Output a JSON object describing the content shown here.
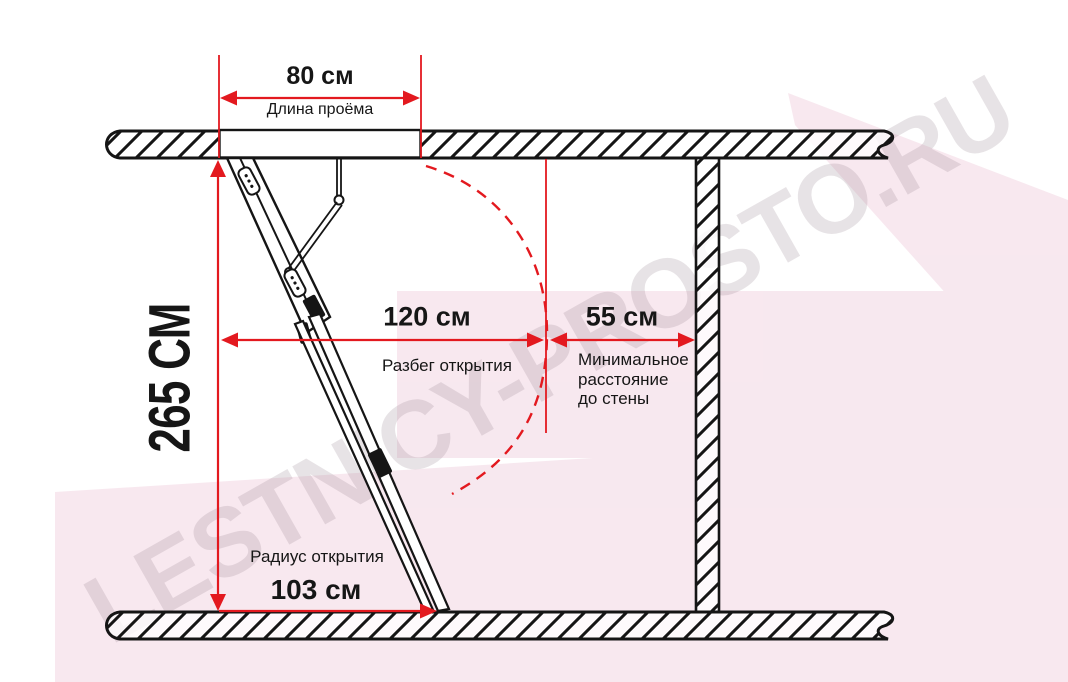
{
  "watermark": {
    "text": "LESTNICY-PROSTO.RU"
  },
  "dimensions": {
    "opening_length": {
      "value": "80 см",
      "label": "Длина проёма"
    },
    "ceiling_height": {
      "value": "265 СМ"
    },
    "opening_run": {
      "value": "120 см",
      "label": "Разбег открытия"
    },
    "wall_distance": {
      "value": "55 см",
      "label_line1": "Минимальное",
      "label_line2": "расстояние",
      "label_line3": "до стены"
    },
    "opening_radius": {
      "value": "103 см",
      "label": "Радиус открытия"
    }
  },
  "colors": {
    "dimension_red": "#e3191f",
    "ink": "#161616",
    "watermark_pink": "#eec9da",
    "watermark_text_gray": "#8d7a86"
  }
}
